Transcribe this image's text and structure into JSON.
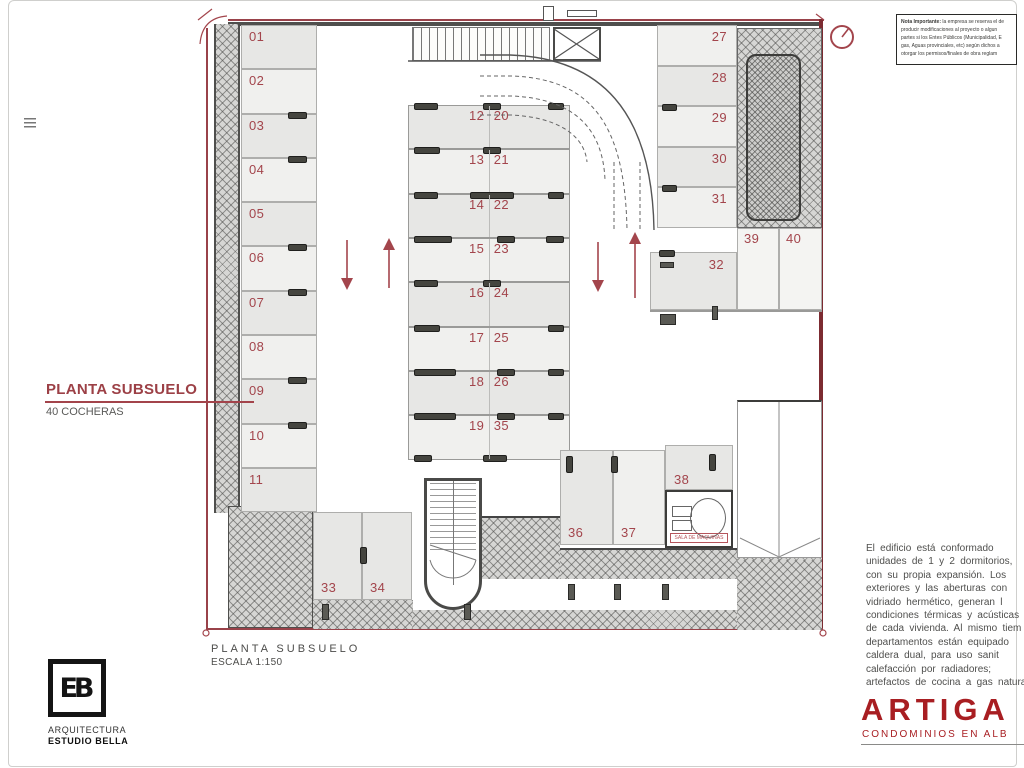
{
  "labels": {
    "plan_title": "PLANTA SUBSUELO",
    "plan_subtitle": "40 COCHERAS",
    "caption_title": "PLANTA SUBSUELO",
    "caption_scale": "ESCALA 1:150",
    "machine_room": "SALA DE MAQUINAS"
  },
  "stalls": {
    "left": [
      "01",
      "02",
      "03",
      "04",
      "05",
      "06",
      "07",
      "08",
      "09",
      "10",
      "11"
    ],
    "middle_left": [
      "12",
      "13",
      "14",
      "15",
      "16",
      "17",
      "18",
      "19"
    ],
    "middle_right": [
      "20",
      "21",
      "22",
      "23",
      "24",
      "25",
      "26",
      "35"
    ],
    "right": [
      "27",
      "28",
      "29",
      "30",
      "31"
    ],
    "stall_32": "32",
    "bottom_left": [
      "33",
      "34"
    ],
    "bottom_right": [
      "36",
      "37"
    ],
    "stall_38": "38",
    "corner": [
      "39",
      "40"
    ]
  },
  "note_box": {
    "title": "Nota Importante:",
    "lines": [
      "la empresa se reserva el de",
      "producir modificaciones al proyecto o algun",
      "partes si los Entes Públicos (Municipalidad, E",
      "gas, Aguas provinciales, etc) según dichos a",
      "otorgar los permisos/finales de obra reglam"
    ]
  },
  "description": {
    "lines": [
      "El edificio está conformado",
      "unidades de 1 y 2 dormitorios,",
      "con su propia expansión. Los",
      "exteriores y las aberturas con",
      "vidriado hermético, generan l",
      "condiciones térmicas y acústicas",
      "de cada vivienda. Al mismo tiem",
      "departamentos están equipado",
      "caldera dual, para uso sanit",
      "calefacción por radiadores;",
      "artefactos de cocina a gas natura"
    ]
  },
  "brand": {
    "name": "ARTIGA",
    "tagline": "CONDOMINIOS EN ALB"
  },
  "studio": {
    "monogram": "EB",
    "line1": "ARQUITECTURA",
    "line2": "ESTUDIO BELLA"
  },
  "colors": {
    "accent_red": "#a3454c",
    "brand_red": "#a81e22",
    "boundary_red": "#99424a",
    "wall_dark": "#4f4f4d",
    "stall_fill_a": "#e7e7e5",
    "stall_fill_b": "#f0f0ee",
    "hatch_gray": "#d6d6d4"
  }
}
